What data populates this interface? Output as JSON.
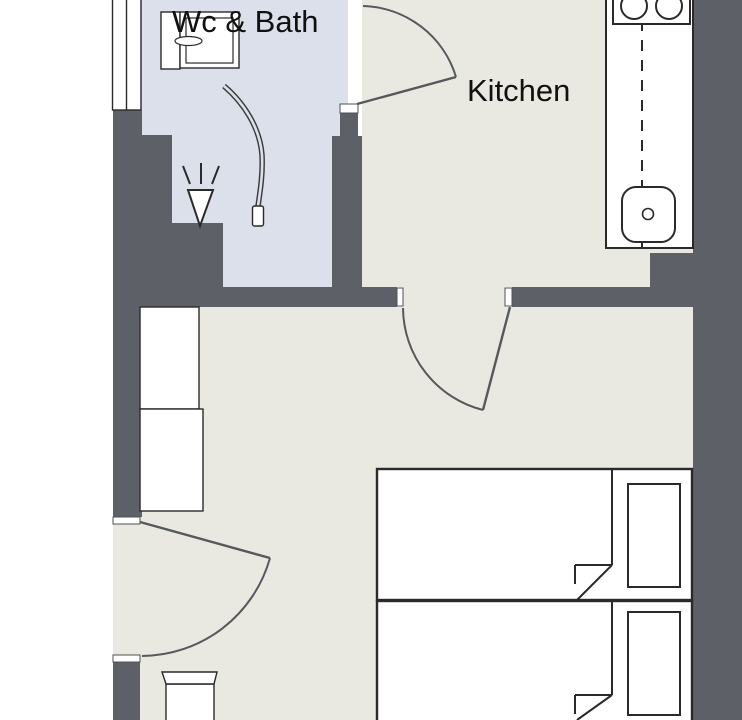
{
  "page": {
    "type": "apartment-floor-plan"
  },
  "labels": {
    "bathroom": "Wc & Bath",
    "kitchen": "Kitchen"
  },
  "colors": {
    "page": "#ffffff",
    "wall": "#5d6067",
    "bath_floor": "#dce0eb",
    "room_floor": "#e9e9e1",
    "fixture": "#ffffff",
    "line": "#2a2a2a",
    "door": "#55585c"
  },
  "rooms": [
    {
      "name": "Wc & Bath",
      "labeled": true,
      "fixtures": [
        "toilet",
        "shower-head",
        "shower-hose",
        "window"
      ]
    },
    {
      "name": "Kitchen",
      "labeled": true,
      "fixtures": [
        "counter",
        "stove-two-burners",
        "sink"
      ]
    },
    {
      "name": "main room",
      "labeled": false,
      "fixtures": [
        "wardrobe",
        "single-bed",
        "single-bed",
        "pillow",
        "pillow",
        "chair"
      ]
    }
  ],
  "counts": {
    "doors": 3,
    "windows": 1,
    "beds": 2
  }
}
